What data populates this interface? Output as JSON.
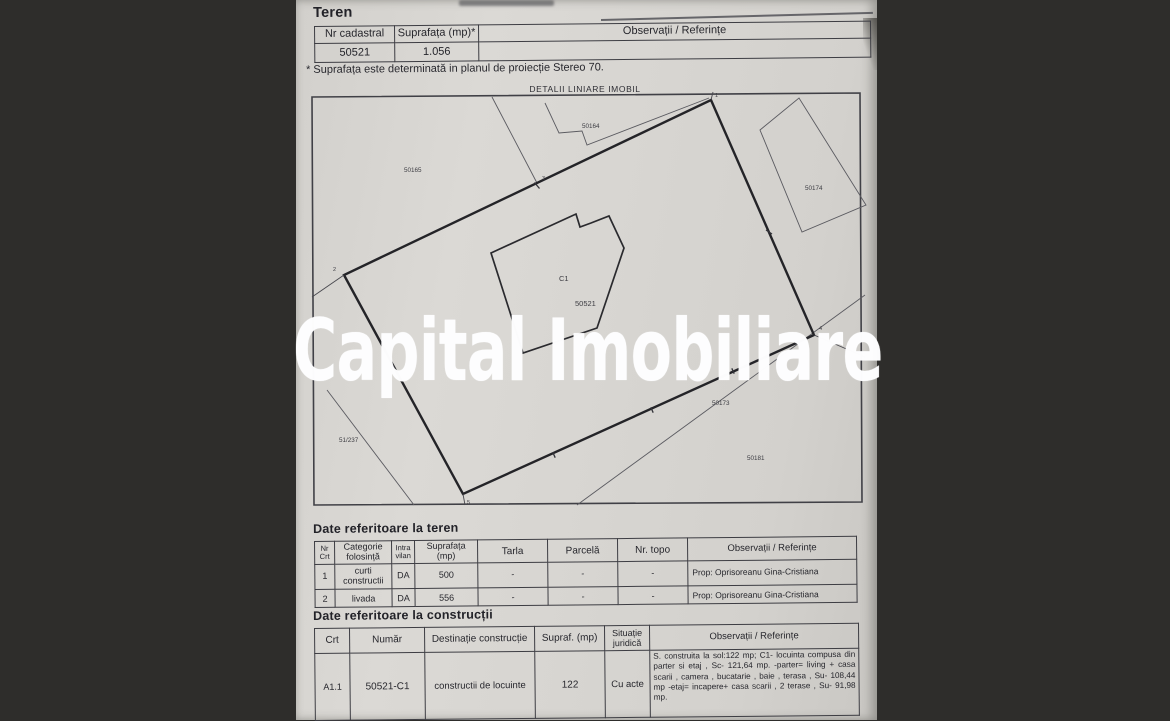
{
  "watermark": {
    "text": "Capital Imobiliare",
    "color": "#ffffff"
  },
  "teren_section": {
    "heading": "Teren",
    "table": {
      "headers": [
        "Nr cadastral",
        "Suprafața (mp)*",
        "Observații / Referințe"
      ],
      "row": {
        "nr_cadastral": "50521",
        "suprafata": "1.056",
        "observatii": ""
      }
    },
    "footnote": "* Suprafața este determinată in planul de proiecție Stereo 70."
  },
  "diagram": {
    "title": "DETALII LINIARE IMOBIL",
    "building_label": "C1",
    "parcel_label": "50521",
    "neighbor_labels": [
      "50165",
      "50164",
      "50174",
      "51/237",
      "50173",
      "50181"
    ],
    "vertex_labels": [
      "1",
      "2",
      "3",
      "4",
      "5"
    ]
  },
  "teren_details_section": {
    "heading": "Date referitoare la teren",
    "table": {
      "headers": [
        "Nr Crt",
        "Categorie folosință",
        "Intra vilan",
        "Suprafața (mp)",
        "Tarla",
        "Parcelă",
        "Nr. topo",
        "Observații / Referințe"
      ],
      "rows": [
        [
          "1",
          "curti constructii",
          "DA",
          "500",
          "-",
          "-",
          "-",
          "Prop: Oprisoreanu Gina-Cristiana"
        ],
        [
          "2",
          "livada",
          "DA",
          "556",
          "-",
          "-",
          "-",
          "Prop: Oprisoreanu Gina-Cristiana"
        ]
      ]
    }
  },
  "constructii_section": {
    "heading": "Date referitoare la construcții",
    "table": {
      "headers": [
        "Crt",
        "Număr",
        "Destinație construcție",
        "Supraf. (mp)",
        "Situație juridică",
        "Observații / Referințe"
      ],
      "row": {
        "crt": "A1.1",
        "numar": "50521-C1",
        "destinatie": "constructii de locuinte",
        "suprafata": "122",
        "situatie": "Cu acte",
        "observatii": "S. construita la sol:122 mp;  C1- locuinta compusa din parter si etaj , Sc- 121,64 mp. -parter= living + casa scarii , camera , bucatarie , baie , terasa , Su- 108,44 mp -etaj= incapere+ casa scarii , 2 terase , Su- 91,98 mp."
      }
    }
  }
}
